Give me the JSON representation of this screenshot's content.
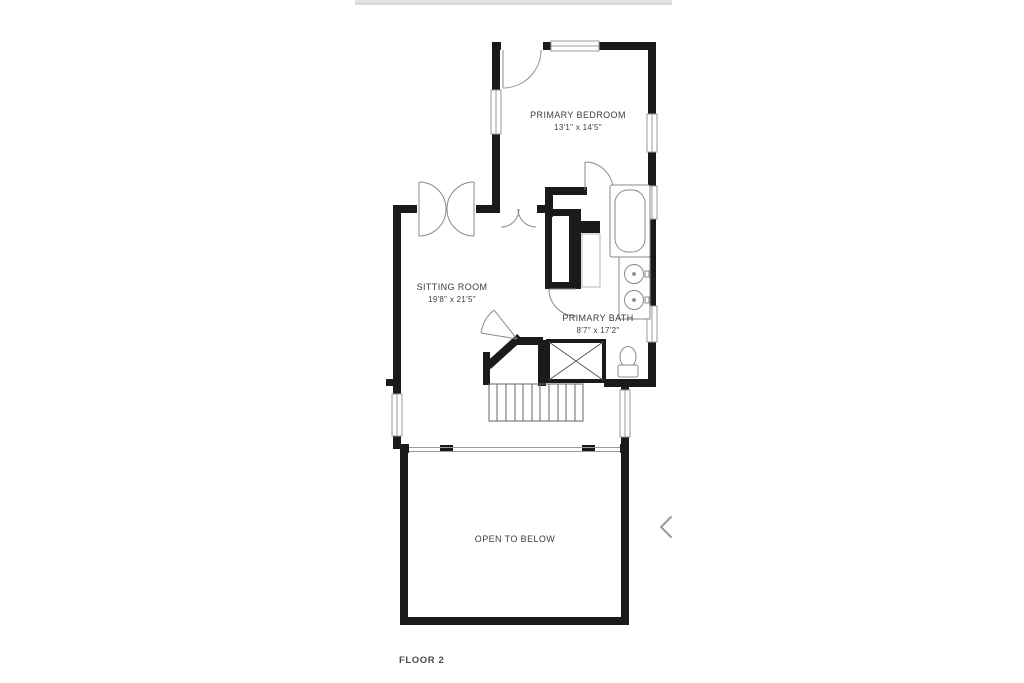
{
  "page": {
    "background": "#ffffff",
    "top_bar_color": "#e3e3e3",
    "wall_color": "#1a1a1a",
    "fixture_line_color": "#8a8a8a",
    "chevron_color": "#9a9a9a"
  },
  "carousel": {
    "prev_icon": "chevron-left"
  },
  "floorplan": {
    "floor_label": "FLOOR 2",
    "rooms": [
      {
        "name": "PRIMARY BEDROOM",
        "dimensions": "13'1\" x 14'5\""
      },
      {
        "name": "SITTING ROOM",
        "dimensions": "19'8\" x 21'5\""
      },
      {
        "name": "PRIMARY BATH",
        "dimensions": "8'7\" x 17'2\""
      },
      {
        "name": "OPEN TO BELOW",
        "dimensions": ""
      }
    ],
    "fixtures": [
      "bathtub",
      "vanity-double-sink",
      "toilet",
      "shower",
      "stairs",
      "closet",
      "railing"
    ]
  }
}
